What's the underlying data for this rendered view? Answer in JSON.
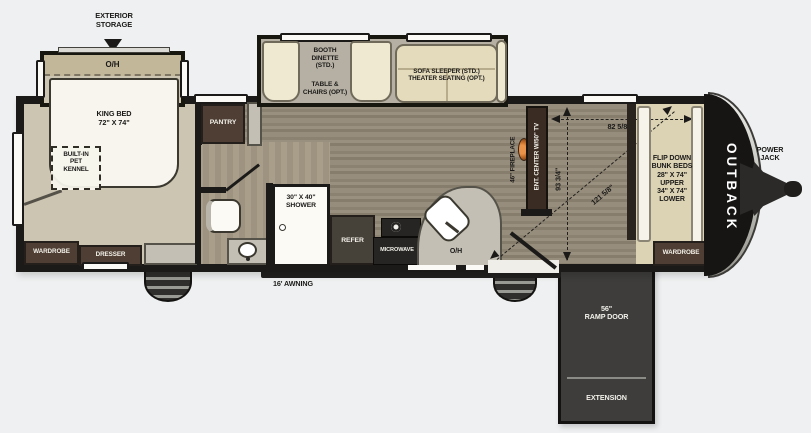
{
  "title": "Outback toy hauler travel trailer floor plan",
  "exterior": {
    "storage_label": "EXTERIOR\nSTORAGE",
    "awning_label": "16' AWNING",
    "power_jack_label": "POWER\nJACK",
    "brand": "OUTBACK",
    "ramp_door_label": "56\"\nRAMP DOOR",
    "extension_label": "EXTENSION"
  },
  "bedroom": {
    "overhead_label": "O/H",
    "king_bed_label": "KING BED\n72\" X 74\"",
    "pet_kennel_label": "BUILT-IN\nPET\nKENNEL",
    "wardrobe_label": "WARDROBE",
    "dresser_label": "DRESSER"
  },
  "kitchen": {
    "pantry_label": "PANTRY",
    "refer_label": "REFER",
    "microwave_label": "MICROWAVE",
    "overhead_label": "O/H",
    "dinette_label": "BOOTH\nDINETTE\n(STD.)",
    "dinette_option_label": "TABLE &\nCHAIRS (OPT.)",
    "sofa_label": "SOFA SLEEPER (STD.)\nTHEATER SEATING (OPT.)"
  },
  "bathroom": {
    "shower_label": "30\" X 40\"\nSHOWER"
  },
  "living": {
    "fireplace_label": "46\" FIREPLACE",
    "ent_center_label": "ENT. CENTER W/50\" TV"
  },
  "garage": {
    "bunk_label": "FLIP DOWN\nBUNK BEDS\n28\" X 74\"\nUPPER\n34\" X 74\"\nLOWER",
    "wardrobe_label": "WARDROBE",
    "measurements": {
      "width": "82 5/8\"",
      "depth": "93 3/4\"",
      "diagonal": "121 5/8\""
    }
  },
  "colors": {
    "wall": "#1b1a18",
    "carpet": "#ccc5b2",
    "wood_floor": "#8f8677",
    "slide_floor": "#b6b0a4",
    "cream_furniture": "#f0e9d1",
    "sofa_tan": "#e4dabc",
    "cabinet_brown": "#4e3e33",
    "appliance_dark": "#262523",
    "counter_gray": "#c3bfb5",
    "bunk_floor": "#dcd3b5",
    "ramp_gray": "#3e3d3b",
    "cap_black": "#161513",
    "fireplace_orange": "#c06a28",
    "background": "#eef0f1"
  }
}
